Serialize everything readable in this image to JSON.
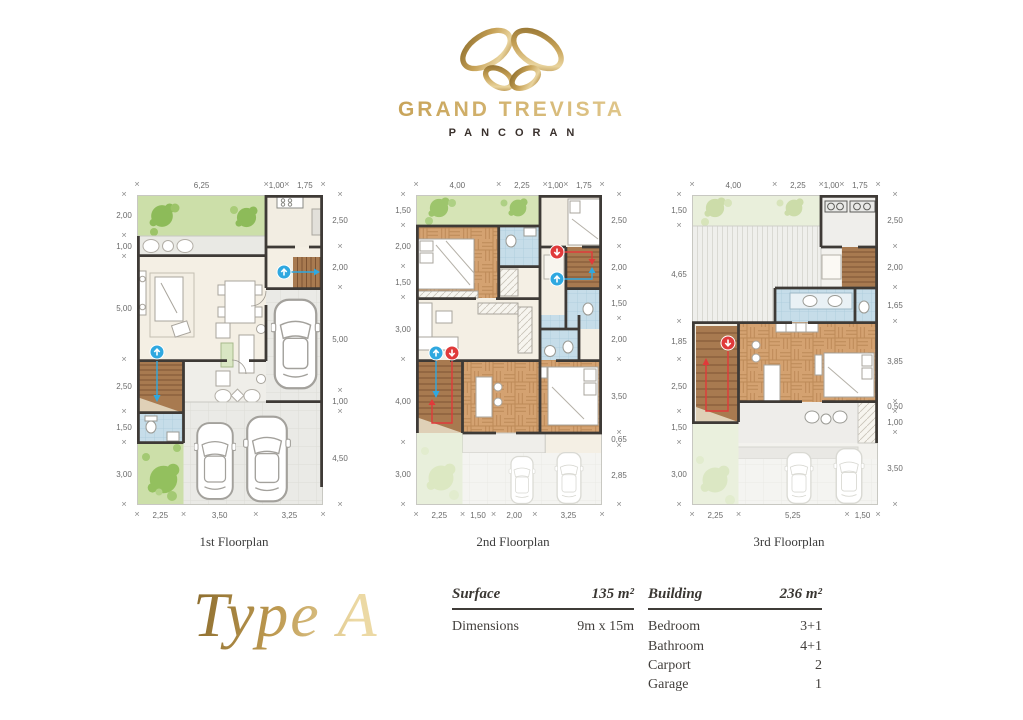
{
  "logo": {
    "brand": "GRAND TREVISTA",
    "subbrand": "PANCORAN",
    "icon": "butterfly-ribbon-icon",
    "gold": "#c9a45c"
  },
  "floorplans": [
    {
      "label": "1st Floorplan",
      "dims": {
        "top": [
          "6,25",
          "1,00",
          "1,75"
        ],
        "left": [
          "2,00",
          "1,00",
          "5,00",
          "2,50",
          "1,50",
          "3,00"
        ],
        "right": [
          "2,50",
          "2,00",
          "5,00",
          "1,00",
          "4,50"
        ],
        "bottom": [
          "2,25",
          "3,50",
          "3,25"
        ]
      },
      "markers": [
        "stair-up-marker",
        "stair-up-marker"
      ]
    },
    {
      "label": "2nd Floorplan",
      "dims": {
        "top": [
          "4,00",
          "2,25",
          "1,00",
          "1,75"
        ],
        "left": [
          "1,50",
          "2,00",
          "1,50",
          "3,00",
          "4,00",
          "3,00"
        ],
        "right": [
          "2,50",
          "2,00",
          "1,50",
          "2,00",
          "3,50",
          "0,65",
          "2,85"
        ],
        "bottom": [
          "2,25",
          "1,50",
          "2,00",
          "3,25"
        ]
      },
      "markers": [
        "stair-down-marker",
        "stair-up-marker",
        "stair-up-marker",
        "stair-down-marker"
      ]
    },
    {
      "label": "3rd Floorplan",
      "dims": {
        "top": [
          "4,00",
          "2,25",
          "1,00",
          "1,75"
        ],
        "left": [
          "1,50",
          "4,65",
          "1,85",
          "2,50",
          "1,50",
          "3,00"
        ],
        "right": [
          "2,50",
          "2,00",
          "1,65",
          "3,85",
          "0,50",
          "1,00",
          "3,50"
        ],
        "bottom": [
          "2,25",
          "5,25",
          "1,50"
        ]
      },
      "markers": [
        "stair-down-marker"
      ]
    }
  ],
  "type_title": "Type A",
  "spec": {
    "left": {
      "header": {
        "label": "Surface",
        "value": "135 m²"
      },
      "rows": [
        {
          "label": "Dimensions",
          "value": "9m x 15m"
        }
      ]
    },
    "right": {
      "header": {
        "label": "Building",
        "value": "236 m²"
      },
      "rows": [
        {
          "label": "Bedroom",
          "value": "3+1"
        },
        {
          "label": "Bathroom",
          "value": "4+1"
        },
        {
          "label": "Carport",
          "value": "2"
        },
        {
          "label": "Garage",
          "value": "1"
        }
      ]
    }
  },
  "colors": {
    "gold": "#c9a45c",
    "wall": "#3e3a36",
    "garden_green": "#cfe0ad",
    "wood_floor": "#d4a271",
    "bath_tile": "#c6dde9",
    "marker_up_blue": "#2fa8e0",
    "marker_down_red": "#e03a3a"
  }
}
